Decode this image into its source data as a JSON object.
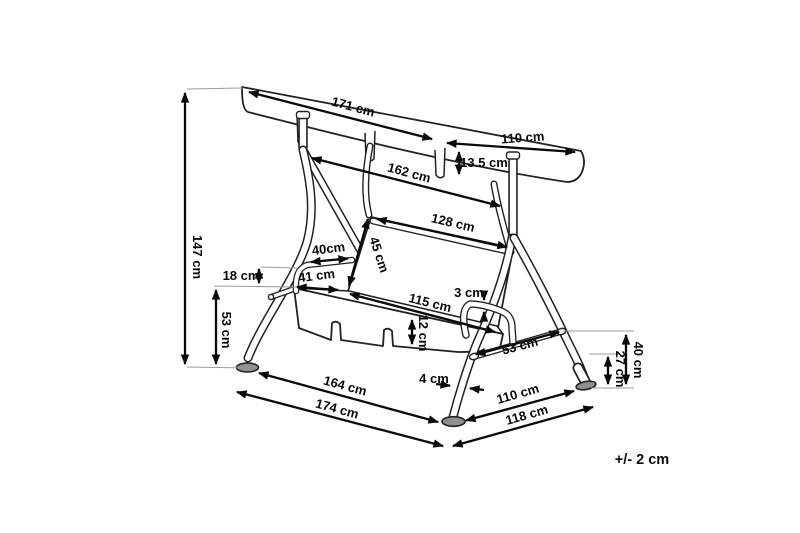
{
  "diagram": {
    "title_hint": "canopy swing seat dimension drawing",
    "labels": {
      "canopy_front_width": "171 cm",
      "canopy_depth": "110 cm",
      "canopy_valance_height": "13.5 cm",
      "frame_top_width": "162 cm",
      "backrest_width": "128 cm",
      "backrest_height": "45 cm",
      "armrest_length": "40cm",
      "seat_depth": "41 cm",
      "armrest_above_seat": "18 cm",
      "seat_height": "53 cm",
      "total_height": "147 cm",
      "seat_width": "115 cm",
      "armrest_tube": "3 cm",
      "seat_front_height": "12 cm",
      "side_strut_length": "53 cm",
      "leg_tube_width": "4 cm",
      "rear_leg_upper": "40 cm",
      "rear_leg_lower": "27 cm",
      "base_front_width": "164 cm",
      "overall_width": "174 cm",
      "base_side_depth": "110 cm",
      "overall_depth": "118 cm",
      "tolerance": "+/- 2 cm"
    }
  }
}
